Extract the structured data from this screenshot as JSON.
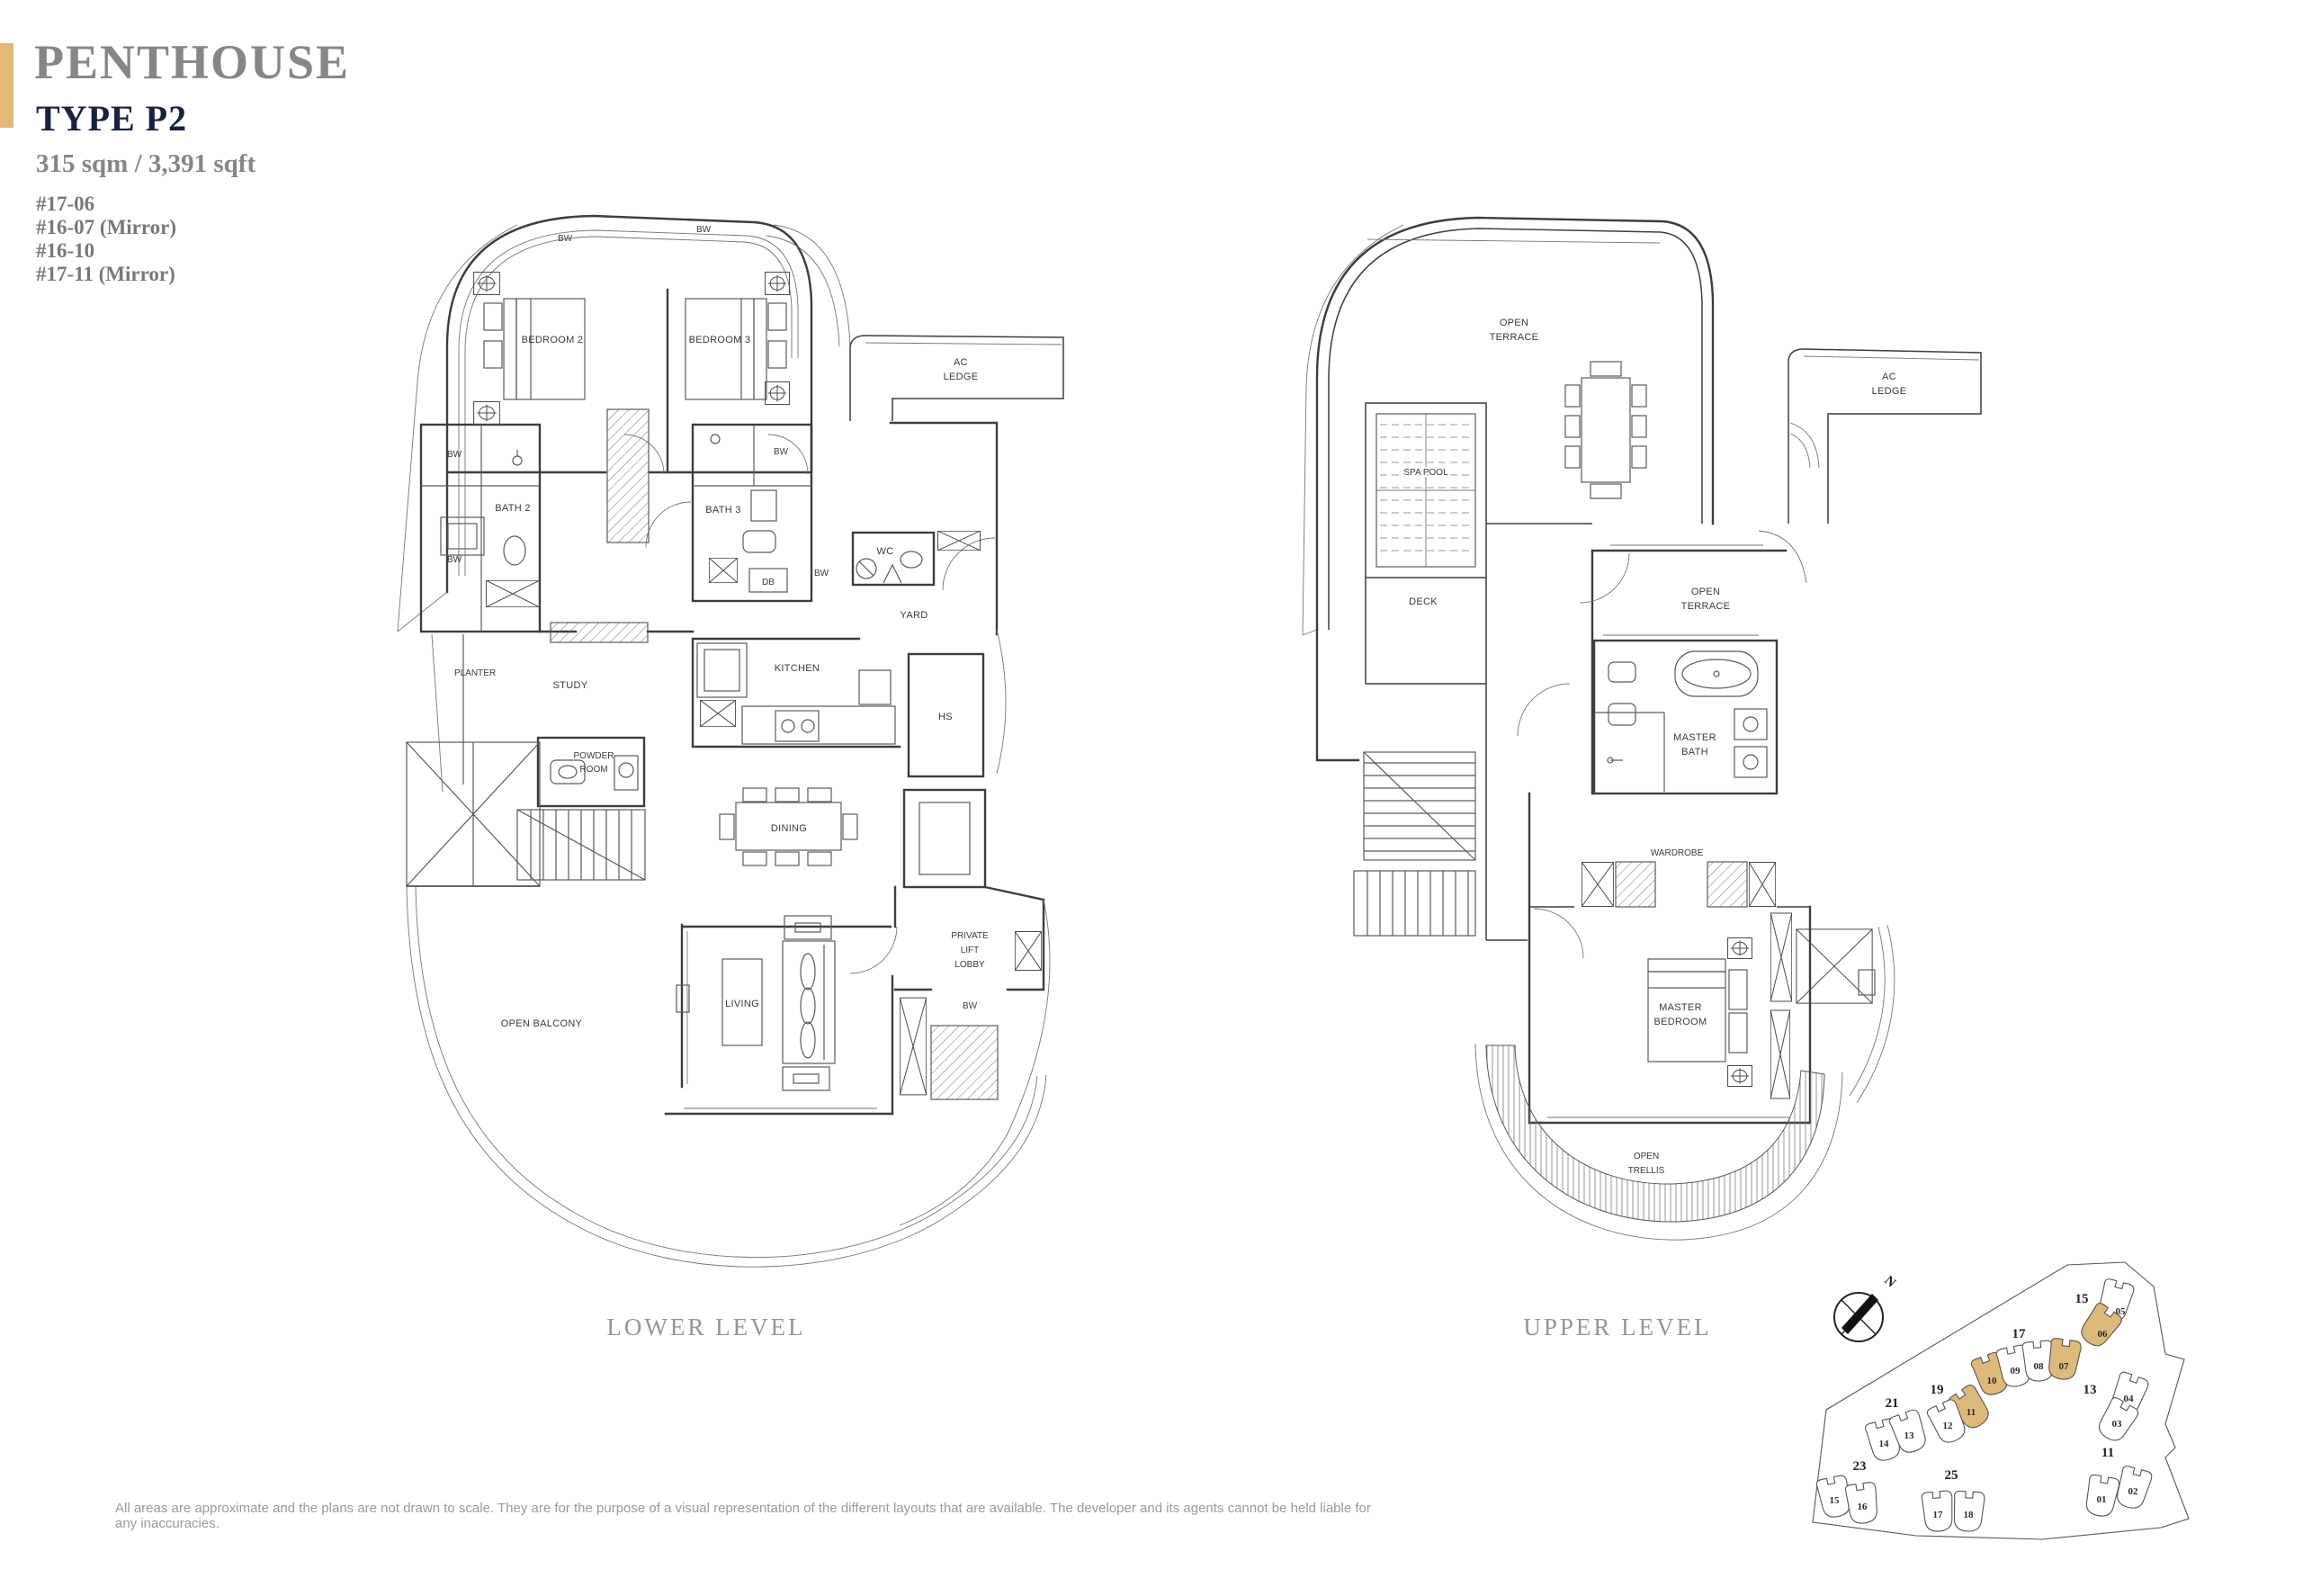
{
  "header": {
    "title": "PENTHOUSE",
    "type": "TYPE P2",
    "area": "315 sqm / 3,391 sqft",
    "units": [
      "#17-06",
      "#16-07 (Mirror)",
      "#16-10",
      "#17-11 (Mirror)"
    ],
    "accent_color": "#e0ba79"
  },
  "lower_level": {
    "caption": "LOWER LEVEL",
    "labels": {
      "bw": "BW",
      "bedroom2": "BEDROOM 2",
      "bedroom3": "BEDROOM 3",
      "ac_ledge": [
        "AC",
        "LEDGE"
      ],
      "bath2": "BATH 2",
      "bath3": "BATH 3",
      "db": "DB",
      "wc": "WC",
      "yard": "YARD",
      "planter": "PLANTER",
      "study": "STUDY",
      "kitchen": "KITCHEN",
      "hs": "HS",
      "powder_room": [
        "POWDER",
        "ROOM"
      ],
      "dining": "DINING",
      "private_lift_lobby": [
        "PRIVATE",
        "LIFT",
        "LOBBY"
      ],
      "living": "LIVING",
      "open_balcony": "OPEN BALCONY"
    }
  },
  "upper_level": {
    "caption": "UPPER LEVEL",
    "labels": {
      "open_terrace": [
        "OPEN",
        "TERRACE"
      ],
      "ac_ledge": [
        "AC",
        "LEDGE"
      ],
      "spa_pool": "SPA POOL",
      "deck": "DECK",
      "open_terrace_2": [
        "OPEN",
        "TERRACE"
      ],
      "master_bath": [
        "MASTER",
        "BATH"
      ],
      "wardrobe": "WARDROBE",
      "master_bedroom": [
        "MASTER",
        "BEDROOM"
      ],
      "open_trellis": [
        "OPEN",
        "TRELLIS"
      ]
    }
  },
  "site_plan": {
    "compass_label": "N",
    "highlight_color": "#ddb97c",
    "blocks": [
      {
        "label": "15",
        "units": [
          {
            "n": "05",
            "hl": false
          },
          {
            "n": "06",
            "hl": true
          }
        ]
      },
      {
        "label": "17",
        "units": [
          {
            "n": "10",
            "hl": true
          },
          {
            "n": "09",
            "hl": false
          },
          {
            "n": "08",
            "hl": false
          },
          {
            "n": "07",
            "hl": true
          }
        ]
      },
      {
        "label": "19",
        "units": [
          {
            "n": "11",
            "hl": true
          },
          {
            "n": "12",
            "hl": false
          }
        ]
      },
      {
        "label": "21",
        "units": [
          {
            "n": "14",
            "hl": false
          },
          {
            "n": "13",
            "hl": false
          }
        ]
      },
      {
        "label": "13",
        "units": [
          {
            "n": "04",
            "hl": false
          },
          {
            "n": "03",
            "hl": false
          }
        ]
      },
      {
        "label": "23",
        "units": [
          {
            "n": "15",
            "hl": false
          },
          {
            "n": "16",
            "hl": false
          }
        ]
      },
      {
        "label": "25",
        "units": [
          {
            "n": "17",
            "hl": false
          },
          {
            "n": "18",
            "hl": false
          }
        ]
      },
      {
        "label": "11",
        "units": [
          {
            "n": "01",
            "hl": false
          },
          {
            "n": "02",
            "hl": false
          }
        ]
      }
    ]
  },
  "footer": {
    "disclaimer": "All areas are approximate and the plans are not drawn to scale. They are for the purpose of a visual representation of the different layouts that are available. The developer and its agents cannot be held liable for any inaccuracies."
  }
}
